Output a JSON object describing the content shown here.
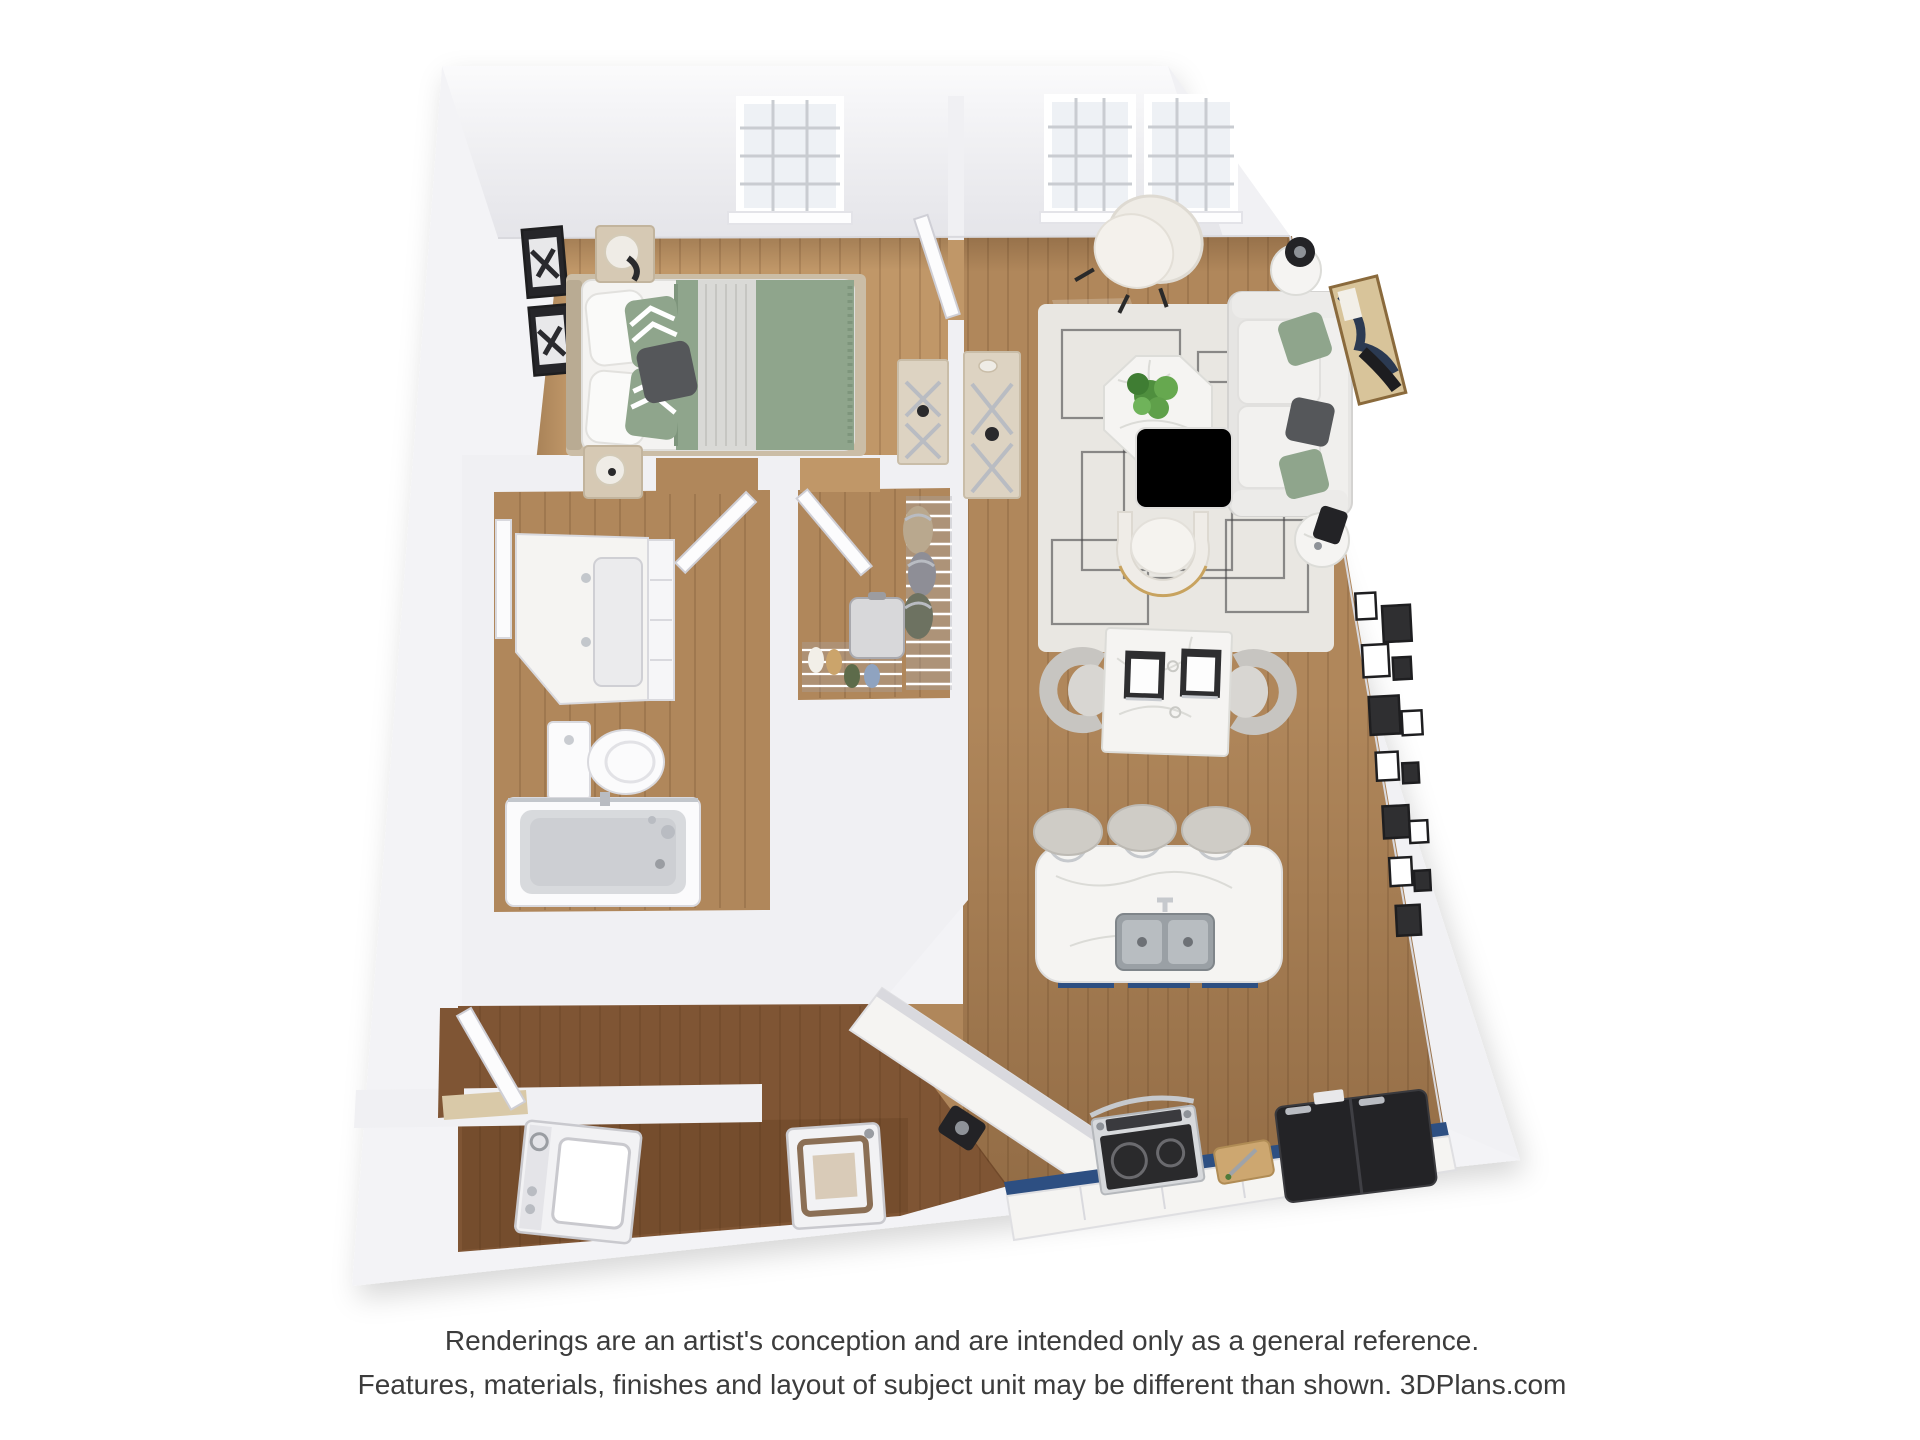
{
  "image": {
    "kind": "3d-floor-plan-rendering",
    "unit": "one-bedroom apartment",
    "view": "top-down dollhouse",
    "width_px": 1920,
    "height_px": 1440
  },
  "footer": {
    "line1": "Renderings are an artist's conception and are intended only as a general reference.",
    "line2": "Features, materials, finishes and layout of subject unit may be different than shown. 3DPlans.com",
    "brand": "3DPlans.com"
  },
  "colors": {
    "wall": "#f3f3f6",
    "wall_face": "#f0f0f3",
    "wood_light": "#c09768",
    "wood_mid": "#b0875b",
    "wood_hall": "#7f5534",
    "navy": "#2d4f82",
    "sage": "#8fa58c",
    "rug": "#e9e7e2",
    "rug_line": "#47474a",
    "marble": "#f5f4f2",
    "charcoal": "#232326",
    "cream": "#efece6",
    "gray_fabric": "#cfccc6",
    "metal": "#b9bcc2",
    "gold": "#c8a35f",
    "orange": "#d8882f",
    "plant": "#55a047",
    "glass": "#eef1f5",
    "text": "#3c3c3c"
  },
  "scene": {
    "floor": "hardwood",
    "walls": "white",
    "rooms": [
      {
        "name": "bedroom",
        "furniture": [
          "queen-bed",
          "sage-throw",
          "chevron-pillows",
          "nightstand",
          "table-lamp",
          "dresser-x-hardware",
          "wall-art",
          "window"
        ]
      },
      {
        "name": "living-room",
        "furniture": [
          "sofa",
          "accent-chair",
          "area-rug",
          "octagon-coffee-table",
          "potted-plant",
          "magazine",
          "round-side-table",
          "black-lamp",
          "console-x-hardware",
          "abstract-artwork",
          "gallery-wall",
          "windows"
        ]
      },
      {
        "name": "dining-area",
        "furniture": [
          "square-marble-table",
          "dining-chairs",
          "place-settings"
        ]
      },
      {
        "name": "kitchen",
        "furniture": [
          "island-double-sink",
          "faucet",
          "bar-stools",
          "navy-cabinets",
          "range",
          "cutting-board",
          "refrigerator",
          "coffee-maker",
          "peninsula-counter"
        ]
      },
      {
        "name": "bathroom",
        "furniture": [
          "vanity-sink",
          "mirror",
          "toilet",
          "tub-shower",
          "glass-door"
        ]
      },
      {
        "name": "walk-in-closet",
        "furniture": [
          "wire-shelving",
          "hanging-clothes",
          "shoes",
          "suitcase"
        ]
      },
      {
        "name": "laundry",
        "furniture": [
          "washer",
          "dryer"
        ]
      },
      {
        "name": "entry",
        "furniture": [
          "entry-door"
        ]
      }
    ]
  }
}
